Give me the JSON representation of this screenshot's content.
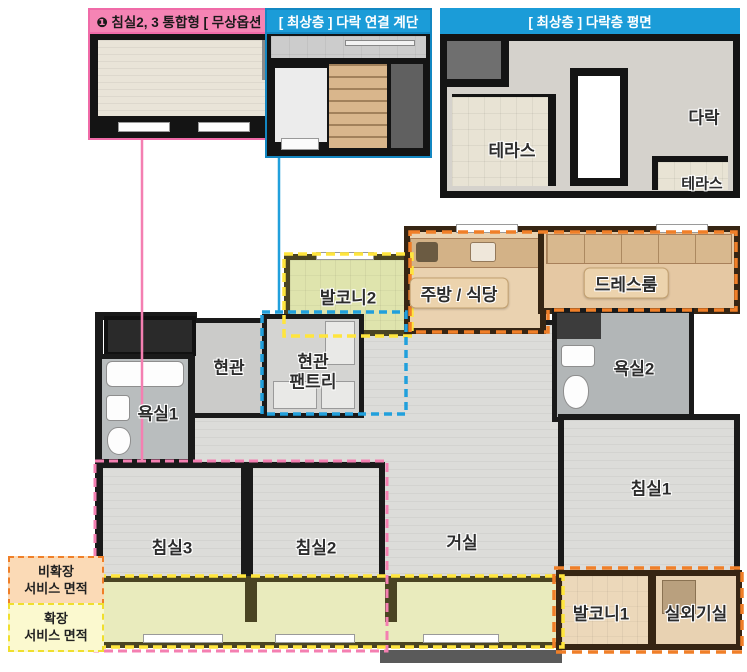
{
  "callouts": {
    "bedroom_option_title": "❶ 침실2, 3 통합형 [ 무상옵션 ]",
    "stair_title": "[ 최상층 ] 다락 연결 계단",
    "attic_title": "[ 최상층 ] 다락층 평면"
  },
  "attic_plan": {
    "terrace_left": "테라스",
    "attic": "다락",
    "terrace_right": "테라스"
  },
  "rooms": {
    "balcony2": "발코니2",
    "kitchen": "주방 / 식당",
    "dressroom": "드레스룸",
    "entrance": "현관",
    "pantry_line1": "현관",
    "pantry_line2": "팬트리",
    "bath1": "욕실1",
    "bath2": "욕실2",
    "bed1": "침실1",
    "bed2": "침실2",
    "bed3": "침실3",
    "living": "거실",
    "balcony1": "발코니1",
    "outdoor_unit": "실외기실"
  },
  "legend": {
    "non_expanded": {
      "line1": "비확장",
      "line2": "서비스 면적"
    },
    "expanded": {
      "line1": "확장",
      "line2": "서비스 면적"
    }
  },
  "colors": {
    "pink": "#f director",
    "pink_header": "#f584b4",
    "pink_dash": "#f47fb1",
    "blue_header": "#1b9cd8",
    "blue_dash": "#21a0dc",
    "orange_dash": "#f07f28",
    "yellow_dash": "#ffe53d",
    "wall_black": "#1a1a1a",
    "wall_brown": "#362513",
    "wall_olive": "#4a4423"
  }
}
